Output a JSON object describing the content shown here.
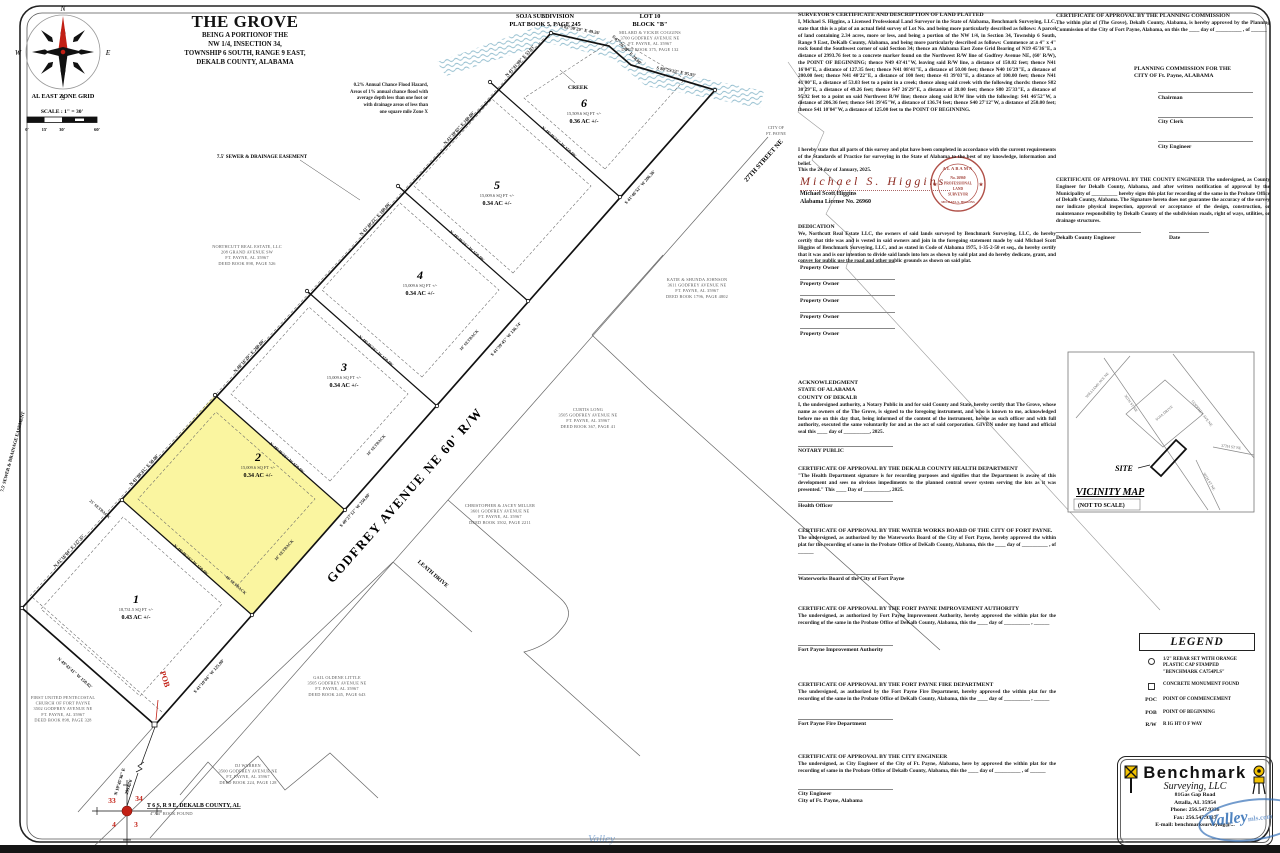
{
  "colors": {
    "lot_highlight": "#FAF5A0",
    "red_accent": "#C22015",
    "creek_blue": "#85B5C8",
    "watermark_blue": "#2F6DB5"
  },
  "title": {
    "main": "THE GROVE",
    "lines": [
      "BEING A PORTIONOF THE",
      "NW 1/4, INSECTION 34,",
      "TOWNSHIP 6 SOUTH, RANGE 9 EAST,",
      "DEKALB COUNTY, ALABAMA"
    ]
  },
  "compass_label": "AL EAST ZONE GRID",
  "scale_label": "SCALE : 1\" = 30'",
  "scale_ticks": [
    "0'",
    "15'",
    "30'",
    "60'"
  ],
  "flood_note": [
    "0.2% Annual Chance Flood Hazard,",
    "Areas of 1% annual chance flood with",
    "average depth less than one foot or",
    "with drainage areas of less than",
    "one square mile Zone X"
  ],
  "plat": {
    "godfrey": "GODFREY AVENUE NE 60' R/W",
    "leath": "LEATH DRIVE",
    "st27": "27TH STREET NE",
    "city": [
      "CITY OF",
      "FT. PAYNE"
    ],
    "creek": "CREEK",
    "soja": [
      "SOJA SUBDIVISION",
      "PLAT BOOK 5, PAGE 245"
    ],
    "lot10": [
      "LOT 10",
      "BLOCK \"B\""
    ],
    "easement": "7.5' SEWER & DRAINAGE EASEMENT",
    "pob": "POB",
    "commence1": "N 19°45'36\" E",
    "commence2": "2993.76'",
    "corner": {
      "n1": "33",
      "n2": "34",
      "n3": "4",
      "n4": "3",
      "t1": "T 6 S, R 9 E, DEKALB COUNTY, AL",
      "t2": "4\"X4\" ROCK FOUND"
    },
    "lots": [
      {
        "num": "1",
        "sqft": "18,731.5 SQ FT +/-",
        "ac": "0.43 AC +/-"
      },
      {
        "num": "2",
        "sqft": "15,009.6 SQ FT +/-",
        "ac": "0.34 AC +/-"
      },
      {
        "num": "3",
        "sqft": "15,009.6 SQ FT +/-",
        "ac": "0.34 AC +/-"
      },
      {
        "num": "4",
        "sqft": "15,009.6 SQ FT +/-",
        "ac": "0.34 AC +/-"
      },
      {
        "num": "5",
        "sqft": "15,009.6 SQ FT +/-",
        "ac": "0.34 AC +/-"
      },
      {
        "num": "6",
        "sqft": "15,509.6 SQ FT +/-",
        "ac": "0.36 AC +/-"
      }
    ],
    "brg_sw": "N 49°43'41\" W 150.02'",
    "brg_nw": [
      "N 41°16'04\" E 127.35'",
      "N 41°08'41\" E 50.00'",
      "N 40°16'29\" E 200.00'",
      "N 41°40'22\" E 100.00'",
      "N 41°39'03\" E 100.00'",
      "N 41°41'00\" E 53.03'"
    ],
    "brg_rw": [
      "S 41°10'04\" W 125.00'",
      "S 40°27'12\" W 250.00'",
      "S 41°39'45\" W 136.74'",
      "S 41°46'52\" W 206.36'"
    ],
    "brg_div": "N 48°49'56\" W 150.00'",
    "brg_creek": [
      "S 82°30'29\" E 49.26'",
      "S 47°26'29\" E 28.00'",
      "S 80°25'33\" E 95.93'"
    ],
    "sb10": "10' SETBACK",
    "sb25": "25' SETBACK",
    "sb40": "40' SETBACK",
    "owners": {
      "coggins": [
        "MILARD & VICKIE COGGINS",
        "3700 GODFREY AVENUE NE",
        "FT. PAYNE, AL 35967",
        "DEED BOOK 375, PAGE 132"
      ],
      "northcutt": [
        "NORTHCUTT REAL ESTATE, LLC",
        "208 GRAND AVENUE SW",
        "FT. PAYNE, AL 35967",
        "DEED BOOK 898, PAGE 526"
      ],
      "johnson": [
        "KATIE & SHUNDA JOHNSON",
        "3611 GODFREY AVENUE NE",
        "FT. PAYNE, AL 35967",
        "DEED BOOK 1796, PAGE 4802"
      ],
      "long": [
        "CURTIS LONG",
        "3505 GODFREY AVENUE NE",
        "FT. PAYNE, AL 35967",
        "DEED BOOK 367, PAGE 41"
      ],
      "miller": [
        "CHRISTOPHER & JACEY MILLER",
        "3601 GODFREY AVENUE NE",
        "FT. PAYNE, AL 35967",
        "DEED BOOK 3502, PAGE 2211"
      ],
      "little": [
        "GAIL OLDENE LITTLE",
        "3505 GODFREY AVENUE NE",
        "FT. PAYNE, AL 35967",
        "DEED BOOK 245, PAGE 643"
      ],
      "church": [
        "FIRST UNITED PENTECOSTAL",
        "CHURCH OF FORT PAYNE",
        "3502 GODFREY AVENUE NE",
        "FT. PAYNE, AL 35967",
        "DEED BOOK 898, PAGE 328"
      ],
      "warren": [
        "DJ WARREN",
        "3500 GODFREY AVENUE NE",
        "FT. PAYNE, AL 35967",
        "DEED BOOK 224, PAGE 128"
      ]
    }
  },
  "certs": {
    "surv": {
      "h": "SURVEYOR'S CERTIFICATE AND DESCRIPTION OF LAND PLATTED",
      "b": "I, Michael S. Higgins, a Licensed Professional Land Surveyor in the State of Alabama, Benchmark Surveying, LLC, state that this is a plat of an actual field survey of Lot No. and being more particularly described as follows: A parcel of land containing 2.34 acres, more or less, and being a portion of the NW 1/4, in Section 34, Township 6 South, Range 9 East, DeKalb County, Alabama, and being more particularly described as follows: Commence at a 4\" x 4\" rock found the Southwest corner of said Section 34; thence an Alabama East Zone Grid Bearing of N19 45'36\"E, a distance of 2993.76 feet to a concrete marker found on the Northwest R/W line of Godfrey Avenue NE, (60' R/W), the POINT OF BEGINNING; thence N49 43'41\"W, leaving said R/W line, a distance of 150.02 feet; thence N41 16'04\"E, a distance of 127.35 feet; thence N41 08'41\"E, a distance of 50.00 feet; thence N40 16'29\"E, a distance of 200.00 feet; thence N41 40'22\"E, a distance of 100 feet; thence 41 39'03\"E, a distance of 100.00 feet; thence N41 41'00\"E, a distance of 53.03 feet to a point in a creek; thence along said creek with the following chords: thence S82 30'29\"E, a distance of 49.26 feet; thence S47 26'29\"E, a distance of 28.00 feet; thence S80 25'33\"E, a distance of 95.92 feet to a point on said Northwest R/W line; thence along said R/W line with the following: S41 46'52\"W, a distance of 206.36 feet; thence S41 39'45\"W, a distance of 136.74 feet; thence S40 27'12\"W, a distance of 250.00 feet; thence S41 10'04\"W, a distance of 125.00 feet to the POINT OF BEGINNING."
    },
    "stmt": {
      "lines": [
        "I hereby state that all parts of this survey and plat have been completed in accordance with the current requirements of the Standards of Practice for surveying in the State of Alabama to the best of my knowledge, information and belief.",
        "This the 24 day of January, 2025."
      ]
    },
    "sig": "Michael S. Higgins",
    "sig_name": "Michael Scott Higgins",
    "sig_lic": "Alabama License No. 26960",
    "seal": [
      "ALABAMA",
      "No. 26960",
      "PROFESSIONAL",
      "LAND",
      "SURVEYOR",
      "MICHAEL S. HIGGINS"
    ],
    "ded": {
      "h": "DEDICATION",
      "b": "We, Northcutt Real Estate LLC, the owners of said lands surveyed by Benchmark Surveying, LLC, do hereby certify that title was and is vested in said owners and join in the foregoing statement made by said Michael Scott Higgins of Benchmark Surveying, LLC, and as stated in Code of Alabama 1975, 1-35-2-50 et seq., do hereby certify that it was and is our intention to divide said lands into lots as shown by said plat and do hereby dedicate, grant, and convey for public use the road and other public grounds as shown on said plat.",
      "owner": "Property Owner"
    },
    "ack": {
      "h1": "ACKNOWLEDGMENT",
      "h2": "STATE OF ALABAMA",
      "h3": "COUNTY OF DEKALB",
      "b": "I, the undersigned authority, a Notary Public in and for said County and State, hereby certify that The Grove, whose name as owners of the The Grove, is signed to the foregoing instrument, and who is known to me, acknowledged before me on this day that, being informed of the content of the instrument, he/she as such officer and with full authority, executed the same voluntarily for and as the act of said corporation. GIVEN under my hand and official seal this ____ day of __________, 2025.",
      "sig": "NOTARY PUBLIC"
    },
    "health": {
      "h": "CERTIFICATE OF APPROVAL BY THE DEKALB COUNTY HEALTH DEPARTMENT",
      "b": "\"The Health Department signature is for recording purposes and signifies that the Department is aware of this development and sees no obvious impediments to the planned central sewer system serving the lots as it was presented.\" This ____ Day of __________, 2025.",
      "sig": "Health Officer"
    },
    "water": {
      "h": "CERTIFICATE OF APPROVAL BY THE WATER WORKS BOARD OF THE CITY OF FORT PAYNE.",
      "b": "The undersigned, as authorized by the Waterworks Board of the City of Fort Payne, hereby approved the within plat for the recording of same in the Probate Office of DeKalb County, Alabama, this the ____ day of __________ , of ______",
      "sig": "Waterworks Board of the City of Fort Payne"
    },
    "impr": {
      "h": "CERTIFICATE OF APPROVAL BY THE FORT PAYNE IMPROVEMENT AUTHORITY",
      "b": "The undersigned, as authorized by Fort Payne Improvement Authority, hereby approved the within plat for the recording of the same in the Probate Office of DeKalb County, Alabama, this the ____ day of __________ , ______",
      "sig": "Fort Payne Improvement Authority"
    },
    "fire": {
      "h": "CERTIFICATE OF APPROVAL BY THE FORT PAYNE FIRE DEPARTMENT",
      "b": "The undersigned, as authorized by the Fort Payne Fire Department, hereby approved the within plat for the recording of the same in the Probate Office of DeKalb County, Alabama, this the ____ day of __________ , ______",
      "sig": "Fort Payne Fire Department"
    },
    "cityeng": {
      "h": "CERTIFICATE OF APPROVAL BY THE CITY ENGINEER",
      "b": "The undersigned, as City Engineer of the City of Ft. Payne, Alabama, here by approved the within plat for the recording of same in the Probate Office of Dekalb County, Alabama, this the ____ day of __________ , of ______",
      "sig1": "City Engineer",
      "sig2": "City of Ft. Payne, Alabama"
    },
    "plan": {
      "h": "CERTIFICATE OF APPROVAL BY THE PLANNING COMMISSION",
      "b": "The within plat of (The Grove), Dekalb County, Alabama, is hereby approved by the Planning Commission of the City of Fort Payne, Alabama, on this the ____ day of __________ , of ______",
      "for1": "PLANNING COMMISSION FOR THE",
      "for2": "CITY OF Ft. Payne, ALABAMA",
      "sigs": [
        "Chairman",
        "City Clerk",
        "City Engineer"
      ]
    },
    "county": {
      "h": "CERTIFICATE OF APPROVAL BY THE COUNTY ENGINEER",
      "b": "The undersigned, as County Engineer for Dekalb County, Alabama, and after written notification of approval by the Municipality of __________ hereby signs this plat for recording of the same in the Probate Office of Dekalb County, Alabama. The Signature hereto does not guarantee the accuracy of the survey nor indicate physical inspection, approval or acceptance of the design, construction, or maintenance responsibility by Dekalb County of the subdivision roads, right of ways, utilities, or drainage structures.",
      "sig": "Dekalb County Engineer",
      "date": "Date"
    }
  },
  "legend": {
    "title": "LEGEND",
    "i1": [
      "1/2\" REBAR SET WITH ORANGE",
      "PLASTIC CAP STAMPED",
      "\"BENCHMARK CA754PLS\""
    ],
    "i2": "CONCRETE MONUMENT FOUND",
    "poc": "POC",
    "poc_t": "POINT OF COMMENCEMENT",
    "pob": "POB",
    "pob_t": "POINT OF BEGINNING",
    "rw": "R/W",
    "rw_t": "R IG HT  O F  WAY"
  },
  "vicinity": {
    "title": "VICINITY MAP",
    "sub": "(NOT TO SCALE)",
    "site": "SITE",
    "roads": {
      "williams": "WILLIAMS AVE NE",
      "st36a": "36TH ST NE",
      "soja": "SOJA DRIVE",
      "godfrey": "GODFREY AVE NE",
      "st37": "37TH ST NE",
      "st36b": "36TH ST NE"
    }
  },
  "firm": {
    "name": "Benchmark",
    "tag": "Surveying, LLC",
    "lines": [
      "81Gas Gap Road",
      "Attalla, AL 35954",
      "Phone: 256.547.9336",
      "Fax: 256.547.9337",
      "E-mail: benchmarksurveying@..."
    ],
    "wm1": "Valley",
    "wm2": "mls.com"
  }
}
